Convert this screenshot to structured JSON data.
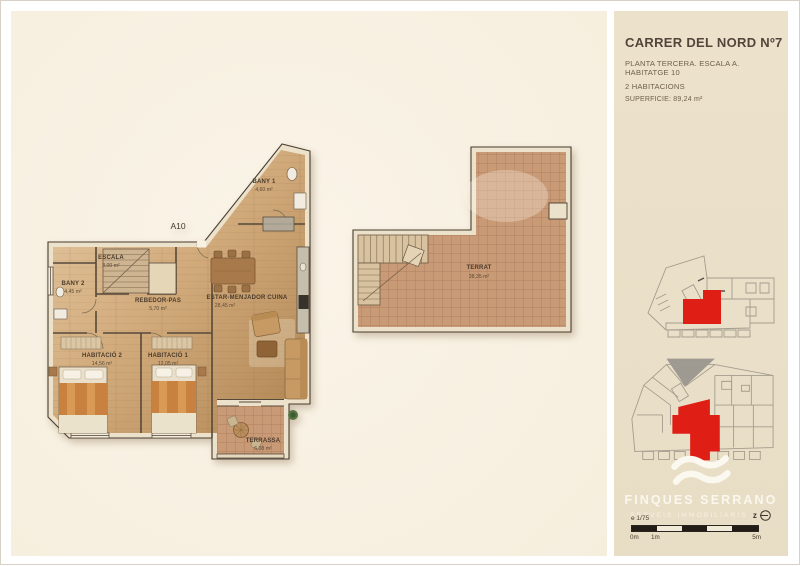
{
  "header": {
    "title": "CARRER DEL NORD Nº7",
    "subtitle": "PLANTA TERCERA. ESCALA A. HABITATGE 10",
    "bedrooms": "2 HABITACIONS",
    "surface": "SUPERFICIE: 89,24 m²"
  },
  "floorplan": {
    "unit_label": "A10",
    "rooms": [
      {
        "name": "BANY 1",
        "area": "4,60 m²"
      },
      {
        "name": "ESCALA",
        "area": "3,00 m²"
      },
      {
        "name": "BANY 2",
        "area": "4,45 m²"
      },
      {
        "name": "REBEDOR-PAS",
        "area": "5,70 m²"
      },
      {
        "name": "ESTAR-MENJADOR CUINA",
        "area": "28,45 m²"
      },
      {
        "name": "HABITACIÓ 2",
        "area": "14,56 m²"
      },
      {
        "name": "HABITACIÓ 1",
        "area": "12,05 m²"
      },
      {
        "name": "TERRASSA",
        "area": "6,08 m²"
      }
    ]
  },
  "terrat": {
    "name": "TERRAT",
    "area": "38,35 m²"
  },
  "branding": {
    "company": "FINQUES SERRANO",
    "tagline": "SERVEIS IMMOBILIARIS",
    "compass_label": "z"
  },
  "scalebar": {
    "ratio": "e 1/75",
    "label_0": "0m",
    "label_1": "1m",
    "label_5": "5m"
  },
  "colors": {
    "highlight_red": "#df1f15",
    "panel_cream": "#f8f1e2",
    "sidebar_beige": "#ebe1cb",
    "wood_tan": "#c9a06f",
    "tile_terracotta": "#c89873"
  }
}
